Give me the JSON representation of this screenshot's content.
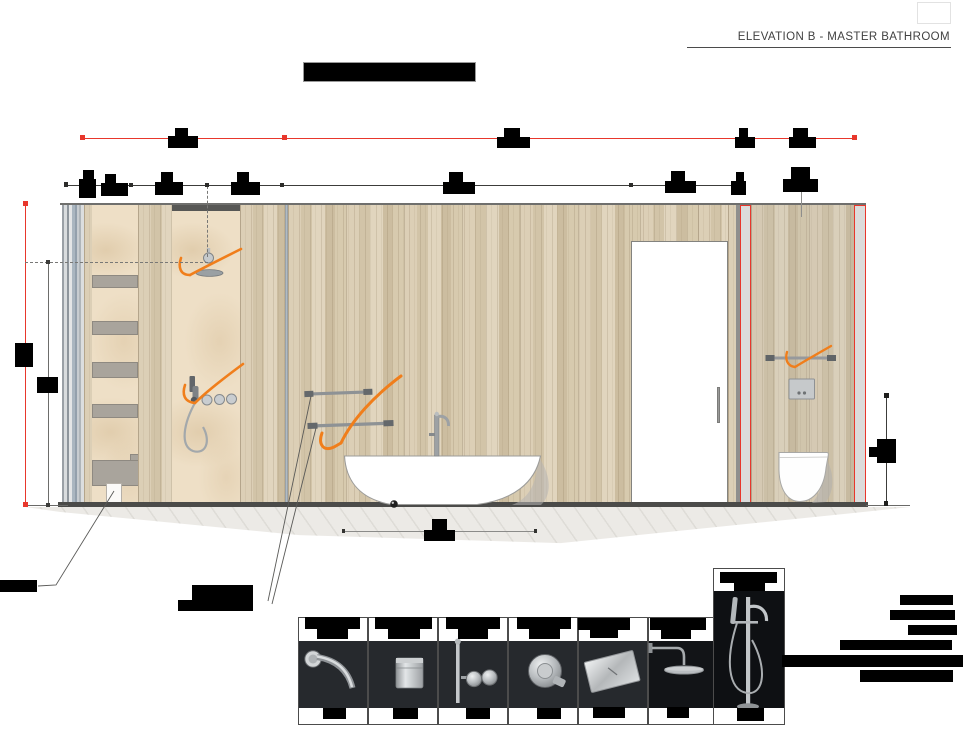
{
  "header": {
    "title": "ELEVATION B - MASTER BATHROOM"
  },
  "palette": {
    "accent_red": "#e8372c",
    "sketch_orange": "#f07e1b",
    "wood_base": "#d5c7ac",
    "marble": "#eedfc6",
    "floor_line": "#4b4b49",
    "photo_background": "#26292d",
    "redaction": "#000000"
  },
  "products": [
    "wall-mounted-spout",
    "cylindrical-mixer",
    "hand-shower-set",
    "round-wall-mixer",
    "steel-flush-plate",
    "wall-rain-shower",
    "freestanding-tub-filler"
  ],
  "drawing": {
    "lines": [
      {
        "n": "red-dim-line",
        "x": 82,
        "y": 137.5,
        "w": 773,
        "h": 1.2,
        "c": "#e8372c"
      },
      {
        "n": "black-dim-line",
        "x": 66,
        "y": 184.5,
        "w": 680,
        "h": 1.1,
        "c": "#3c3c3a"
      },
      {
        "n": "left-red-vertical-dim",
        "x": 25,
        "y": 203,
        "w": 1.2,
        "h": 302,
        "c": "#e8372c"
      },
      {
        "n": "left-gray-vertical-dim",
        "x": 48,
        "y": 262,
        "w": 1.1,
        "h": 243,
        "c": "#6d6d6b"
      },
      {
        "n": "right-vertical-dim",
        "x": 886,
        "y": 395,
        "w": 1.1,
        "h": 108,
        "c": "#3c3c3a"
      },
      {
        "n": "tub-dim-line",
        "x": 343,
        "y": 530.5,
        "w": 192,
        "h": 1,
        "c": "#8b8b89"
      },
      {
        "n": "flushplate-leader",
        "x": 801,
        "y": 190,
        "w": 1,
        "h": 27,
        "c": "#8e8e8c"
      },
      {
        "n": "dashed-vertical-axis",
        "x": 207,
        "y": 186,
        "w": 0,
        "h": 71,
        "c": "#787876",
        "dash": 1
      },
      {
        "n": "dashed-height-line",
        "x": 25,
        "y": 261.5,
        "w": 183,
        "h": 0,
        "c": "#787876",
        "dash": 1
      }
    ],
    "ticks": [
      {
        "x": 79.5,
        "y": 135,
        "s": 5,
        "c": "#e8372c"
      },
      {
        "x": 282,
        "y": 135,
        "s": 5,
        "c": "#e8372c"
      },
      {
        "x": 852,
        "y": 135,
        "s": 5,
        "c": "#e8372c"
      },
      {
        "x": 63.5,
        "y": 182,
        "s": 4.5,
        "c": "#2c2c2a"
      },
      {
        "x": 129,
        "y": 182.5,
        "s": 4,
        "c": "#2c2c2a"
      },
      {
        "x": 204.5,
        "y": 182.5,
        "s": 4,
        "c": "#2c2c2a"
      },
      {
        "x": 280,
        "y": 182.5,
        "s": 4,
        "c": "#2c2c2a"
      },
      {
        "x": 629,
        "y": 183,
        "s": 3.5,
        "c": "#2c2c2a"
      },
      {
        "x": 22.8,
        "y": 200.8,
        "s": 5,
        "c": "#e8372c"
      },
      {
        "x": 22.8,
        "y": 502,
        "s": 5,
        "c": "#e8372c"
      },
      {
        "x": 45.8,
        "y": 259.8,
        "s": 4.2,
        "c": "#3c3c3a"
      },
      {
        "x": 46,
        "y": 502.5,
        "s": 4,
        "c": "#3c3c3a"
      },
      {
        "x": 883.5,
        "y": 392.8,
        "s": 5,
        "c": "#1e1e1c"
      },
      {
        "x": 883.8,
        "y": 501,
        "s": 4.5,
        "c": "#1e1e1c"
      },
      {
        "x": 341.5,
        "y": 529,
        "s": 3.5,
        "c": "#333331"
      },
      {
        "x": 533.5,
        "y": 529,
        "s": 3.5,
        "c": "#333331"
      }
    ],
    "redactions": [
      {
        "x": 303,
        "y": 62,
        "w": 171,
        "h": 18,
        "b": 1
      },
      {
        "x": 175,
        "y": 128,
        "w": 13,
        "h": 8
      },
      {
        "x": 168,
        "y": 135.5,
        "w": 30,
        "h": 12.5
      },
      {
        "x": 504,
        "y": 128,
        "w": 16,
        "h": 9
      },
      {
        "x": 497,
        "y": 136.5,
        "w": 33,
        "h": 11.5
      },
      {
        "x": 739,
        "y": 128,
        "w": 9,
        "h": 9
      },
      {
        "x": 734.5,
        "y": 137,
        "w": 20,
        "h": 11
      },
      {
        "x": 793,
        "y": 128,
        "w": 14.5,
        "h": 9
      },
      {
        "x": 788.5,
        "y": 137,
        "w": 27,
        "h": 11
      },
      {
        "x": 83,
        "y": 169.5,
        "w": 11,
        "h": 9.5
      },
      {
        "x": 79,
        "y": 179,
        "w": 17,
        "h": 19
      },
      {
        "x": 105,
        "y": 173.5,
        "w": 11,
        "h": 9.5
      },
      {
        "x": 101,
        "y": 183,
        "w": 27,
        "h": 12.5
      },
      {
        "x": 161,
        "y": 172,
        "w": 12,
        "h": 10
      },
      {
        "x": 155,
        "y": 182,
        "w": 28,
        "h": 13
      },
      {
        "x": 237,
        "y": 172,
        "w": 12,
        "h": 10
      },
      {
        "x": 231,
        "y": 182,
        "w": 29,
        "h": 13
      },
      {
        "x": 449,
        "y": 171.5,
        "w": 14,
        "h": 10.5
      },
      {
        "x": 443,
        "y": 182,
        "w": 32,
        "h": 12
      },
      {
        "x": 671,
        "y": 170.5,
        "w": 14,
        "h": 10.5
      },
      {
        "x": 665,
        "y": 181,
        "w": 31,
        "h": 12
      },
      {
        "x": 736,
        "y": 171.5,
        "w": 8,
        "h": 9.5
      },
      {
        "x": 730.5,
        "y": 181,
        "w": 15.5,
        "h": 14
      },
      {
        "x": 791,
        "y": 166.5,
        "w": 19,
        "h": 12.5
      },
      {
        "x": 783,
        "y": 179,
        "w": 35,
        "h": 13
      },
      {
        "x": 15,
        "y": 343,
        "w": 18,
        "h": 24
      },
      {
        "x": 37,
        "y": 377,
        "w": 21,
        "h": 16
      },
      {
        "x": 869,
        "y": 446.5,
        "w": 9,
        "h": 10.5
      },
      {
        "x": 877,
        "y": 438.5,
        "w": 19,
        "h": 24
      },
      {
        "x": 432,
        "y": 519,
        "w": 15,
        "h": 11.5
      },
      {
        "x": 424,
        "y": 530,
        "w": 31,
        "h": 10.5
      },
      {
        "x": 0,
        "y": 580,
        "w": 37,
        "h": 12
      },
      {
        "x": 192,
        "y": 585,
        "w": 61,
        "h": 15
      },
      {
        "x": 178,
        "y": 600,
        "w": 75,
        "h": 11
      },
      {
        "x": 900,
        "y": 595,
        "w": 53,
        "h": 10
      },
      {
        "x": 890,
        "y": 610,
        "w": 65,
        "h": 10
      },
      {
        "x": 908,
        "y": 625,
        "w": 49,
        "h": 10
      },
      {
        "x": 840,
        "y": 640,
        "w": 112,
        "h": 10
      },
      {
        "x": 782,
        "y": 654.5,
        "w": 181,
        "h": 12.5
      },
      {
        "x": 860,
        "y": 669.5,
        "w": 93,
        "h": 12.5
      },
      {
        "x": 305,
        "y": 617,
        "w": 55,
        "h": 12
      },
      {
        "x": 317,
        "y": 629,
        "w": 31,
        "h": 9.5
      },
      {
        "x": 375,
        "y": 617,
        "w": 57,
        "h": 12
      },
      {
        "x": 388,
        "y": 629,
        "w": 32,
        "h": 9.5
      },
      {
        "x": 446,
        "y": 617,
        "w": 54,
        "h": 12
      },
      {
        "x": 458,
        "y": 629,
        "w": 30,
        "h": 9.5
      },
      {
        "x": 517,
        "y": 617,
        "w": 54,
        "h": 12
      },
      {
        "x": 529,
        "y": 629,
        "w": 31,
        "h": 9.5
      },
      {
        "x": 578,
        "y": 618,
        "w": 52,
        "h": 11.5
      },
      {
        "x": 590,
        "y": 629.5,
        "w": 28,
        "h": 8.5
      },
      {
        "x": 650,
        "y": 618,
        "w": 56,
        "h": 12
      },
      {
        "x": 661,
        "y": 630,
        "w": 30,
        "h": 8.5
      },
      {
        "x": 720,
        "y": 571.5,
        "w": 57,
        "h": 11.5
      },
      {
        "x": 734,
        "y": 583,
        "w": 31,
        "h": 8
      },
      {
        "x": 323,
        "y": 708,
        "w": 23,
        "h": 11
      },
      {
        "x": 393,
        "y": 708,
        "w": 25,
        "h": 11
      },
      {
        "x": 466,
        "y": 708,
        "w": 24,
        "h": 11
      },
      {
        "x": 537,
        "y": 708,
        "w": 24,
        "h": 11
      },
      {
        "x": 593,
        "y": 707,
        "w": 32,
        "h": 11
      },
      {
        "x": 667,
        "y": 707,
        "w": 22,
        "h": 11
      },
      {
        "x": 737,
        "y": 708,
        "w": 27,
        "h": 13
      }
    ]
  }
}
